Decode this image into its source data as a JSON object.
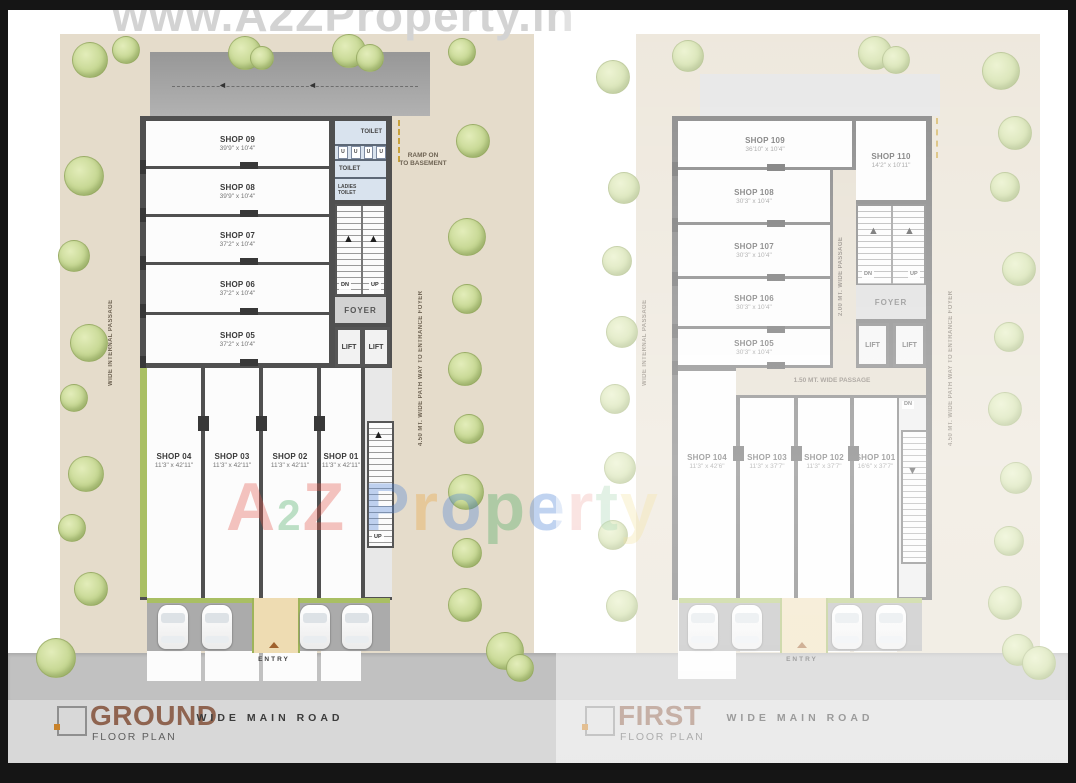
{
  "watermark": {
    "top_url": "www.A2ZProperty.in",
    "brand": {
      "a2z": [
        {
          "ch": "A",
          "color": "#e3544a"
        },
        {
          "ch": "2",
          "color": "#44a85c",
          "small": true
        },
        {
          "ch": "Z",
          "color": "#e3544a"
        }
      ],
      "property": [
        {
          "ch": "P",
          "color": "#4a80d6"
        },
        {
          "ch": "r",
          "color": "#e8a33c"
        },
        {
          "ch": "o",
          "color": "#4a80d6"
        },
        {
          "ch": "p",
          "color": "#45a85e"
        },
        {
          "ch": "e",
          "color": "#4a80d6"
        },
        {
          "ch": "r",
          "color": "#e3544a"
        },
        {
          "ch": "t",
          "color": "#45a85e"
        },
        {
          "ch": "y",
          "color": "#e8c53c"
        }
      ]
    }
  },
  "icons": {
    "up_arrow": "▲",
    "down_arrow": "▼",
    "left_arrow": "◄"
  },
  "legend": {
    "ground": {
      "title": "GROUND",
      "subtitle": "FLOOR PLAN"
    },
    "first": {
      "title": "FIRST",
      "subtitle": "FLOOR PLAN"
    },
    "road_label": "WIDE MAIN ROAD",
    "title_color": "#8f6450"
  },
  "ground_plan": {
    "shops_top": [
      {
        "name": "SHOP 09",
        "dim": "39'9\" x 10'4\""
      },
      {
        "name": "SHOP 08",
        "dim": "39'9\" x 10'4\""
      },
      {
        "name": "SHOP 07",
        "dim": "37'2\" x 10'4\""
      },
      {
        "name": "SHOP 06",
        "dim": "37'2\" x 10'4\""
      },
      {
        "name": "SHOP 05",
        "dim": "37'2\" x 10'4\""
      }
    ],
    "shops_bottom": [
      {
        "name": "SHOP 04",
        "dim": "11'3\" x 42'11\""
      },
      {
        "name": "SHOP 03",
        "dim": "11'3\" x 42'11\""
      },
      {
        "name": "SHOP 02",
        "dim": "11'3\" x 42'11\""
      },
      {
        "name": "SHOP 01",
        "dim": "11'3\" x 42'11\""
      }
    ],
    "toilets": {
      "toilet_top": "TOILET",
      "urinals": [
        "U",
        "U",
        "U",
        "U"
      ],
      "toilet_mid": "TOILET",
      "ladies_1": "LADIES",
      "ladies_2": "TOILET"
    },
    "foyer": "FOYER",
    "lift": "LIFT",
    "stair": {
      "dn": "DN",
      "up": "UP"
    },
    "ramp_note_1": "RAMP ON",
    "ramp_note_2": "TO BASEMENT",
    "passage_left": "WIDE INTERNAL PASSAGE",
    "pathway_right": "4.50 MT. WIDE PATH WAY TO ENTRANCE FOYER",
    "entry": "ENTRY"
  },
  "first_plan": {
    "shops_top": [
      {
        "name": "SHOP 109",
        "dim": "36'10\" x 10'4\""
      },
      {
        "name": "SHOP 108",
        "dim": "30'3\" x 10'4\""
      },
      {
        "name": "SHOP 107",
        "dim": "30'3\" x 10'4\""
      },
      {
        "name": "SHOP 106",
        "dim": "30'3\" x 10'4\""
      },
      {
        "name": "SHOP 105",
        "dim": "30'3\" x 10'4\""
      }
    ],
    "shop_corner": {
      "name": "SHOP 110",
      "dim": "14'2\" x 10'11\""
    },
    "shops_bottom": [
      {
        "name": "SHOP 104",
        "dim": "11'3\" x 42'6\""
      },
      {
        "name": "SHOP 103",
        "dim": "11'3\" x 37'7\""
      },
      {
        "name": "SHOP 102",
        "dim": "11'3\" x 37'7\""
      },
      {
        "name": "SHOP 101",
        "dim": "16'6\" x 37'7\""
      }
    ],
    "foyer": "FOYER",
    "lift": "LIFT",
    "stair": {
      "dn": "DN",
      "up": "UP"
    },
    "passage_vertical": "2.00 MT. WIDE PASSAGE",
    "passage_horizontal": "1.50 MT. WIDE PASSAGE",
    "passage_left": "WIDE INTERNAL PASSAGE",
    "pathway_right": "4.50 MT. WIDE PATH WAY TO ENTRANCE FOYER",
    "entry": "ENTRY"
  }
}
